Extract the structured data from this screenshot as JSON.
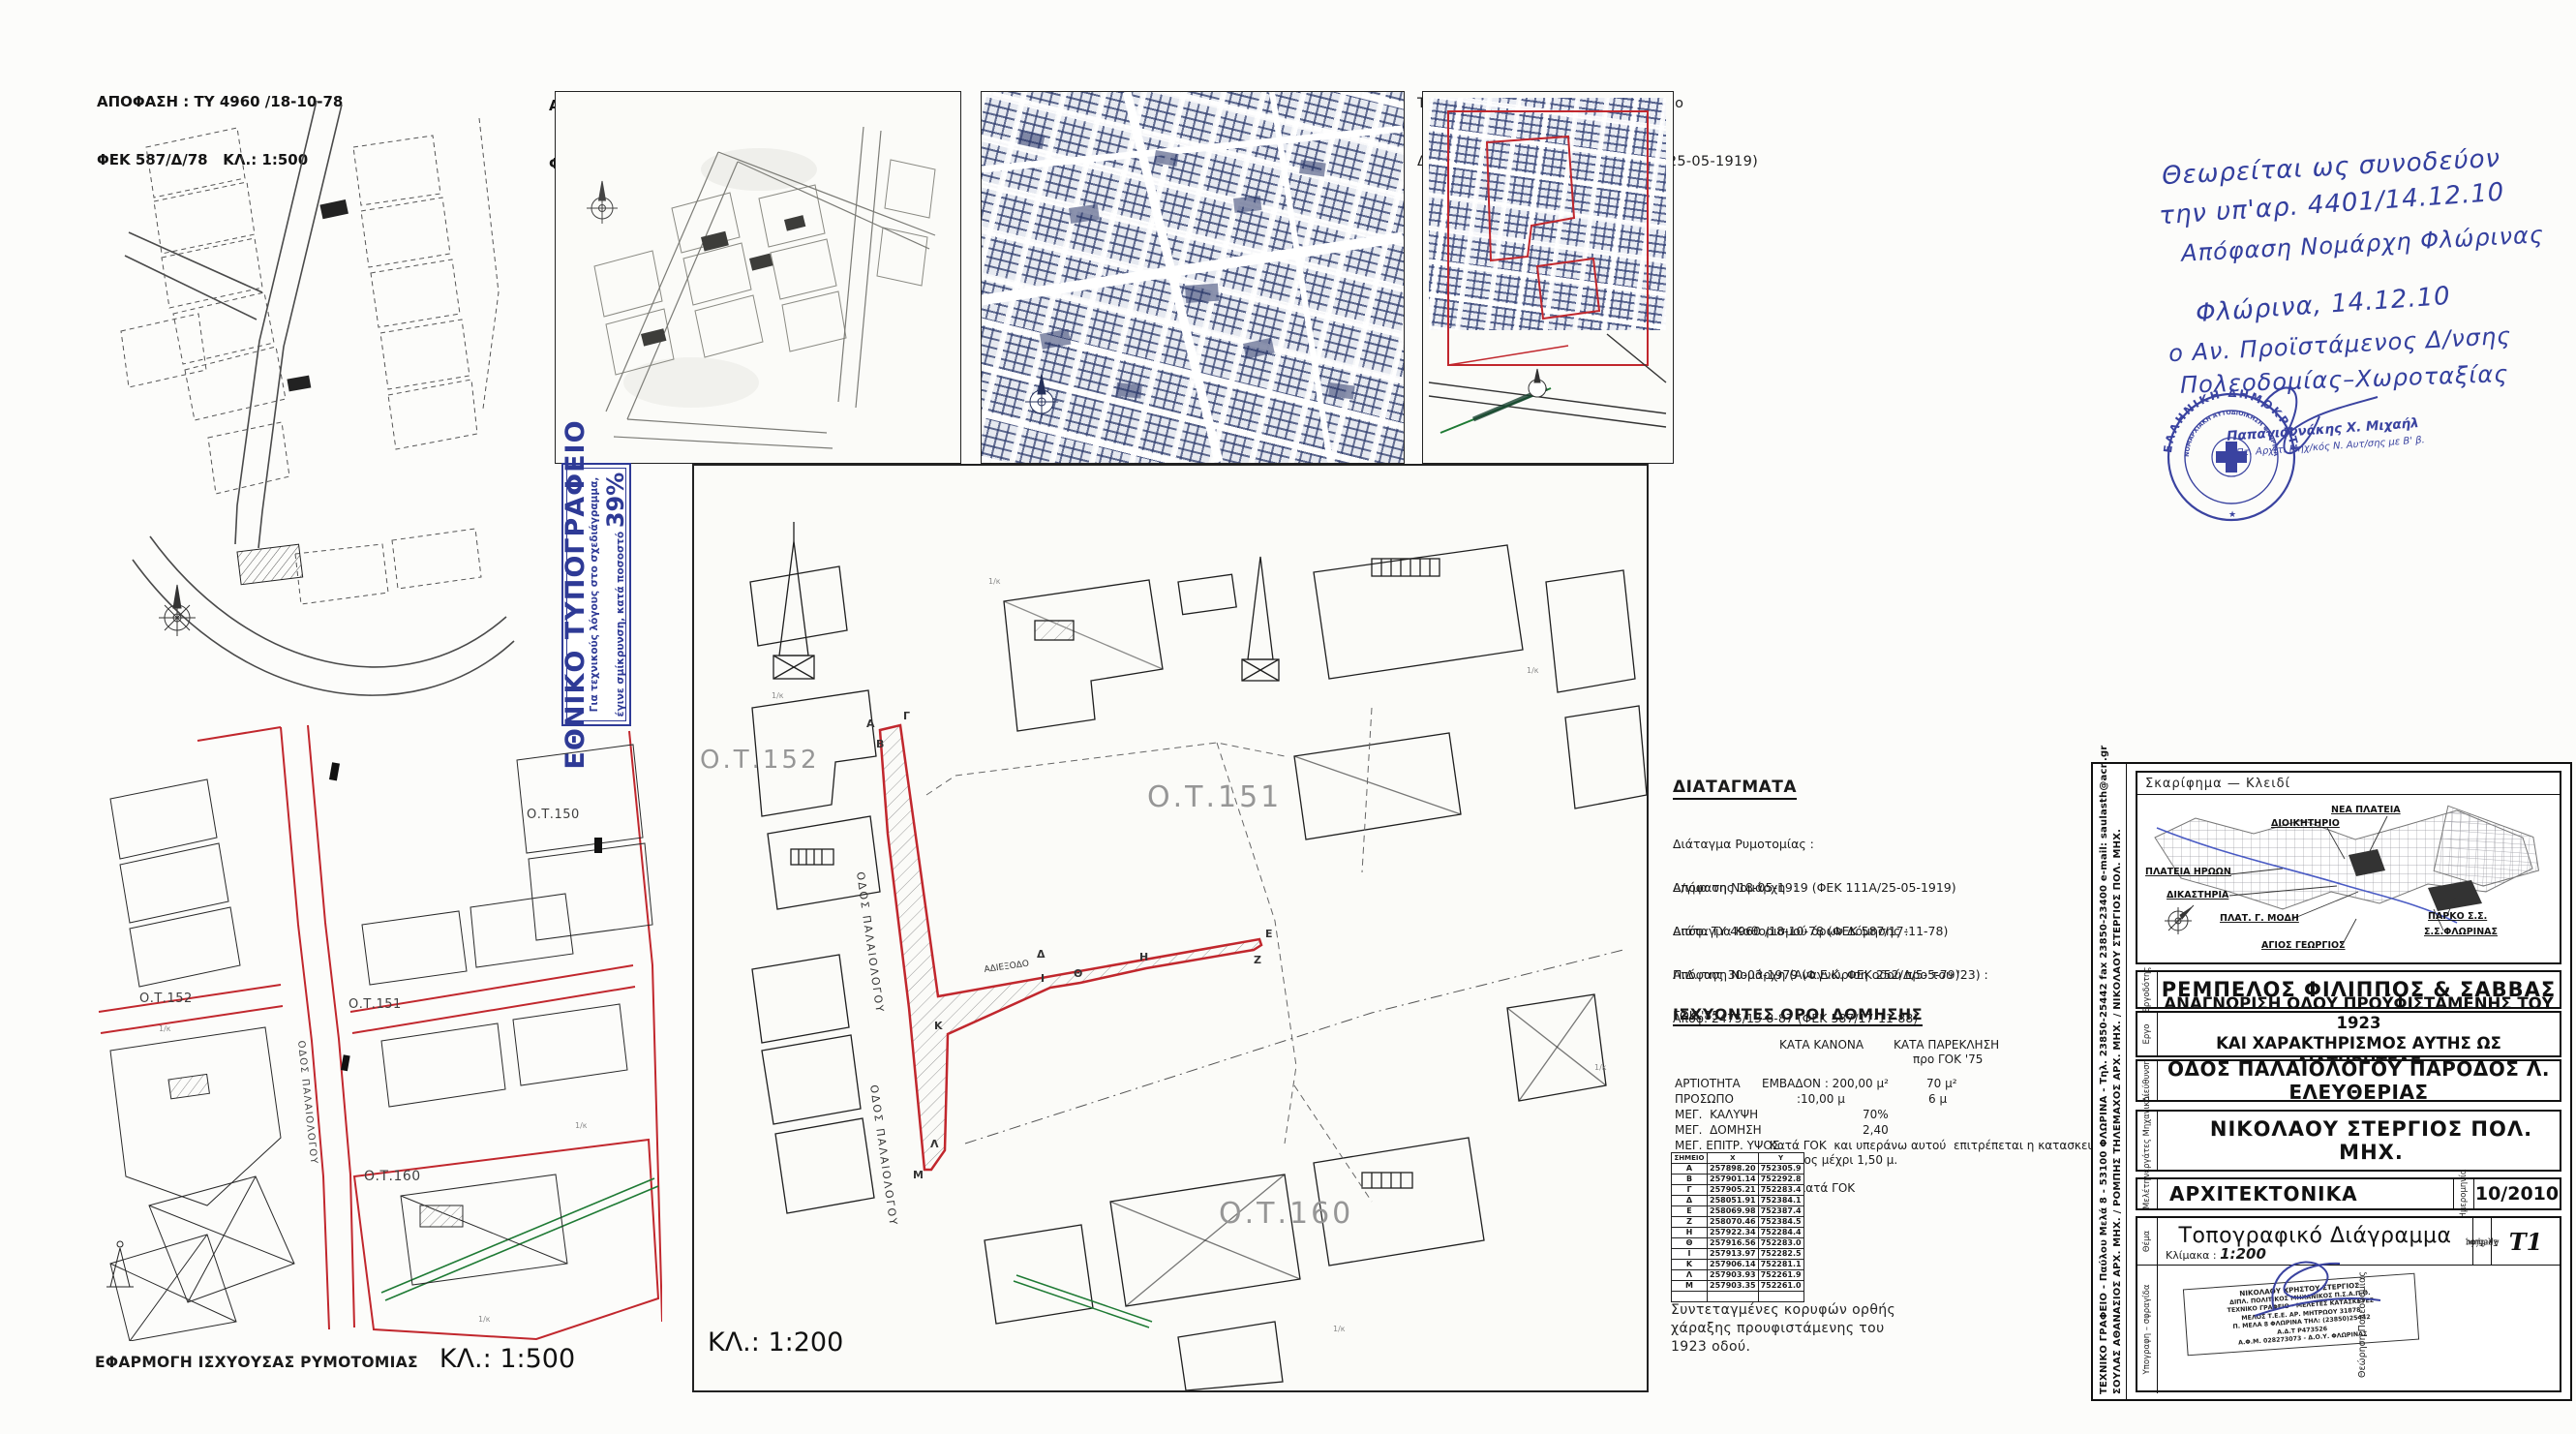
{
  "panels": {
    "p1": {
      "l1": "ΑΠΟΦΑΣΗ : ΤΥ 4960 /18-10-78",
      "l2": "ΦΕΚ 587/Δ/78   ΚΛ.: 1:500"
    },
    "p2": {
      "l1": "ΑΠΟΦΑΣΗ ΝΟΜΑΡΧΗ : 2475/13-8-87",
      "l2": "ΦΕΚ 82/Δ/88   ΚΛ.: 1:500"
    },
    "p3": {
      "l1": "Διάταγμα Ρυμοτομίας :",
      "l2": "Δ/γμα της 18-05-1919 (ΦΕΚ 111Α/25-05-1919)"
    },
    "p4": {
      "l1": "Ταύτιση γραμμής (ΑΒΓ... ΚΛΜ) με το",
      "l2": "Δ/γμα της 18-05-1919 (ΦΕΚ 111Α/25-05-1919)"
    }
  },
  "print_stamp": {
    "title": "ΕΘΝΙΚΟ ΤΥΠΟΓΡΑΦΕΙΟ",
    "note1": "Για τεχνικούς λόγους στο σχεδιάγραμμα,",
    "note2": "έγινε σμίκρυνση, κατά ποσοστό",
    "percent": "39%"
  },
  "handnote": {
    "l1": "Θεωρείται ως συνοδεύον",
    "l2": "την υπ'αρ.  4401/14.12.10",
    "l3": "Απόφαση Νομάρχη Φλώρινας",
    "l4": "Φλώρινα, 14.12.10",
    "l5": "ο Αν. Προϊστάμενος Δ/νσης",
    "l6": "Πολεοδομίας–Χωροταξίας",
    "stamp_outer": "ΕΛΛΗΝΙΚΗ ΔΗΜΟΚΡΑΤΙΑ",
    "stamp_inner": "ΝΟΜΑΡΧΙΑΚΗ ΑΥΤΟΔΙΟΙΚΗΣΗ ΦΛΩΡΙΝΑΣ",
    "signer_name": "Παπαγιαννάκης Χ. Μιχαήλ",
    "signer_title": "Πτ. Αρχιτ. Μηχ/κός Ν. Αυτ/σης με Β' β."
  },
  "left_map": {
    "caption": "ΕΦΑΡΜΟΓΗ ΙΣΧΥΟΥΣΑΣ ΡΥΜΟΤΟΜΙΑΣ",
    "scale": "ΚΛ.: 1:500",
    "ot150": "Ο.Τ.150",
    "ot151": "Ο.Τ.151",
    "ot152": "Ο.Τ.152",
    "ot160": "Ο.Τ.160",
    "street": "ΟΔΟΣ ΠΑΛΑΙΟΛΟΓΟΥ"
  },
  "center_map": {
    "scale": "ΚΛ.: 1:200",
    "ot151": "Ο.Τ.151",
    "ot152": "Ο.Τ.152",
    "ot160": "Ο.Τ.160",
    "street": "ΟΔΟΣ ΠΑΛΑΙΟΛΟΓΟΥ",
    "dead_end": "ΑΔΙΕΞΟΔΟ",
    "points": [
      "Α",
      "Β",
      "Γ",
      "Δ",
      "Ε",
      "Ζ",
      "Η",
      "Θ",
      "Ι",
      "Κ",
      "Λ",
      "Μ"
    ]
  },
  "misc": {
    "small_label": "1/κ"
  },
  "decrees": {
    "heading": "ΔΙΑΤΑΓΜΑΤΑ",
    "items": [
      {
        "l1": "Διάταγμα Ρυμοτομίας :",
        "l2": "Δ/γμα της 18-05-1919 (ΦΕΚ 111Α/25-05-1919)"
      },
      {
        "l1": "Απόφαση Νομάρχη  :",
        "l2": "Απόφ. ΤΥ 4960 /18-10-78 (ΦΕΚ 587/17-11-78)"
      },
      {
        "l1": "Διάταγμα Καθορισμού όρων Δόμησης :",
        "l2": "Π.Δ. της 30-03-1979 (Φ.Ε.Κ. ΦΕΚ 252/Δ/5-5-79)"
      },
      {
        "l1": "Απόφαση Νομάρχη (Αναγνώριση οδού προ του '23) :",
        "l2": "Απόφ. 2475/13-8-87 (ΦΕΚ 587/17-11-88)"
      },
      {
        "l1": "ΓΟΚ '85",
        "l2": ""
      }
    ]
  },
  "terms": {
    "heading": "ΙΣΧΥΟΝΤΕΣ   ΟΡΟΙ ΔΟΜΗΣΗΣ",
    "colA": "ΚΑΤΑ ΚΑΝΟΝΑ",
    "colB": "ΚΑΤΑ ΠΑΡΕΚΛΗΣΗ",
    "colB2": "προ ΓΟΚ '75",
    "r1l": "ΑΡΤΙΟΤΗΤΑ",
    "r1a": "ΕΜΒΑΔΟΝ : 200,00 μ²",
    "r1b": "70 μ²",
    "r2l": "ΠΡΟΣΩΠΟ",
    "r2a": ":10,00 μ",
    "r2b": "6 μ",
    "r3l": "ΜΕΓ.  ΚΑΛΥΨΗ",
    "r3a": "70%",
    "r4l": "ΜΕΓ.  ΔΟΜΗΣΗ",
    "r4a": "2,40",
    "r5l": "ΜΕΓ. ΕΠΙΤΡ. ΥΨΟΣ",
    "r5a": "Κατά ΓΟΚ  και υπεράνω αυτού  επιτρέπεται η κατασκευή στέγης",
    "r5b": "Με ύψος μέχρι 1,50 μ.",
    "footer": "Λοιποί όροι δόμησης κατά ΓΟΚ"
  },
  "coords": {
    "headers": [
      "ΣΗΜΕΙΟ",
      "Χ",
      "Υ"
    ],
    "rows": [
      [
        "Α",
        "257898.20",
        "752305.9"
      ],
      [
        "Β",
        "257901.14",
        "752292.8"
      ],
      [
        "Γ",
        "257905.21",
        "752283.4"
      ],
      [
        "Δ",
        "258051.91",
        "752384.1"
      ],
      [
        "Ε",
        "258069.98",
        "752387.4"
      ],
      [
        "Ζ",
        "258070.46",
        "752384.5"
      ],
      [
        "Η",
        "257922.34",
        "752284.4"
      ],
      [
        "Θ",
        "257916.56",
        "752283.0"
      ],
      [
        "Ι",
        "257913.97",
        "752282.5"
      ],
      [
        "Κ",
        "257906.14",
        "752281.1"
      ],
      [
        "Λ",
        "257903.93",
        "752261.9"
      ],
      [
        "Μ",
        "257903.35",
        "752261.0"
      ],
      [
        "",
        "",
        ""
      ]
    ],
    "cap1": "Συντεταγμένες κορυφών ορθής",
    "cap2": "χάραξης προυφιστάμενης του",
    "cap3": "1923 οδού."
  },
  "titleblock": {
    "sidebar1": "ΤΕΧΝΙΚΟ ΓΡΑΦΕΙΟ - Παύλου Μελά 8 - 53100 ΦΛΩΡΙΝΑ - Τηλ. 23850-25442 fax 23850-23400 e-mail: saulasth@acn.gr",
    "sidebar2": "ΣΟΥΛΑΣ ΑΘΑΝΑΣΙΟΣ ΑΡΧ. ΜΗΧ. / ΡΟΜΠΗΣ ΤΗΛΕΜΑΧΟΣ ΑΡΧ. ΜΗΧ. / ΝΙΚΟΛΑΟΥ ΣΤΕΡΓΙΟΣ ΠΟΛ. ΜΗΧ.",
    "sketch_title": "Σκαρίφημα  —  Κλειδί",
    "labels": {
      "nea_plateia": "ΝΕΑ ΠΛΑΤΕΙΑ",
      "dioikitirio": "ΔΙΟΙΚΗΤΗΡΙΟ",
      "plateia_iroon": "ΠΛΑΤΕΙΑ ΗΡΩΩΝ",
      "dikastiria": "ΔΙΚΑΣΤΗΡΙΑ",
      "plat_modi": "ΠΛΑΤ. Γ. ΜΟΔΗ",
      "parko": "ΠΑΡΚΟ  Σ.Σ.",
      "ss_florinas": "Σ.Σ.ΦΛΩΡΙΝΑΣ",
      "agios_georgios": "ΑΓΙΟΣ  ΓΕΩΡΓΙΟΣ"
    },
    "rows": {
      "ergodotis_label": "Εργοδότης",
      "ergodotis": "ΡΕΜΠΕΛΟΣ ΦΙΛΙΠΠΟΣ & ΣΑΒΒΑΣ",
      "ergo_label": "Εργο",
      "ergo1": "ΑΝΑΓΝΩΡΙΣΗ ΟΔΟΥ ΠΡΟΫΦΙΣΤΑΜΕΝΗΣ ΤΟΥ 1923",
      "ergo2": "ΚΑΙ ΧΑΡΑΚΤΗΡΙΣΜΟΣ ΑΥΤΗΣ ΩΣ ΔΙΑΤΗΡΗΤΕΑΣ",
      "diefthynsi_label": "Διεύθυνση",
      "diefthynsi": "ΟΔΟΣ ΠΑΛΑΙΟΛΟΓΟΥ ΠΑΡΟΔΟΣ Λ. ΕΛΕΥΘΕΡΙΑΣ",
      "synergates_label": "Συνεργάτες Μηχανικοί",
      "synergates": "ΝΙΚΟΛΑΟΥ ΣΤΕΡΓΙΟΣ ΠΟΛ. ΜΗΧ.",
      "meleti_label": "Μελέτη",
      "meleti": "ΑΡΧΙΤΕΚΤΟΝΙΚΑ",
      "imerominia_label": "Ημερομηνία",
      "imerominia": "10/2010",
      "thema_label": "Θέμα",
      "thema": "Τοπογραφικό Διάγραμμα",
      "klimaka_label": "Κλίμακα :",
      "klimaka": "1:200",
      "arithmos_label1": "Αριθμός",
      "arithmos_label2": "Σχεδίου",
      "arithmos": "Τ1",
      "ypografi_label": "Υπογραφη – σφραγίδα",
      "theorisi_label": "Θεώρηση  Πολεοδομίας"
    },
    "stamp_lines": {
      "s1": "ΝΙΚΟΛΑΟΥ  ΧΡΗΣΤΟΥ  ΣΤΕΡΓΙΟΣ",
      "s2": "ΔΙΠΛ. ΠΟΛΙΤΙΚΟΣ ΜΗΧΑΝΙΚΟΣ  Π.Σ.Α.Π.Θ.",
      "s3": "ΤΕΧΝΙΚΟ ΓΡΑΦΕΙΟ - ΜΕΛΕΤΕΣ ΚΑΤΑΣΚΕΥΕΣ",
      "s4": "ΜΕΛΟΣ Τ.Ε.Ε.   ΑΡ. ΜΗΤΡΩΟΥ  31878",
      "s5": "Π. ΜΕΛΑ 8   ΦΛΩΡΙΝΑ   ΤΗΛ: (23850)25442",
      "s6": "Α.Δ.Τ   Ρ473526",
      "s7": "Α.Φ.Μ. 028273073 - Δ.Ο.Υ.  ΦΛΩΡΙΝΑΣ"
    }
  },
  "colors": {
    "red": "#c1272d",
    "green": "#1e7a34",
    "ink": "#333f9e",
    "blueprint": "#2c3a6b"
  }
}
